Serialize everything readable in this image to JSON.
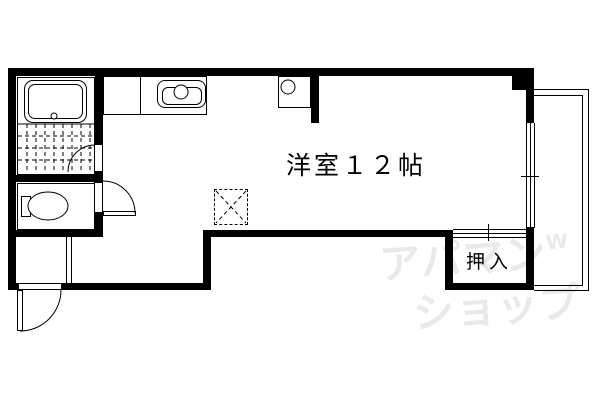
{
  "floorplan": {
    "main_room": {
      "label": "洋室１２帖"
    },
    "closet": {
      "label": "押入"
    },
    "watermark": {
      "line1": "アパマン",
      "mark": "W",
      "line2": "ショップ",
      "color": "#e9e9e9"
    },
    "colors": {
      "wall": "#000000",
      "line": "#000000",
      "background": "#ffffff"
    },
    "fixtures": {
      "bathtub-icon": "rounded rectangle with drain circle",
      "tile-floor-icon": "dashed grid",
      "toilet-icon": "ellipse bowl with tank rectangle",
      "kitchen-sink-icon": "rounded rectangle with faucet circle",
      "water-heater-icon": "square with burner circle",
      "washing-machine-space-icon": "dashed square with X cross",
      "door-swing-icon": "quarter-circle arc",
      "sliding-window-icon": "parallel lines",
      "balcony-icon": "double outline"
    }
  }
}
